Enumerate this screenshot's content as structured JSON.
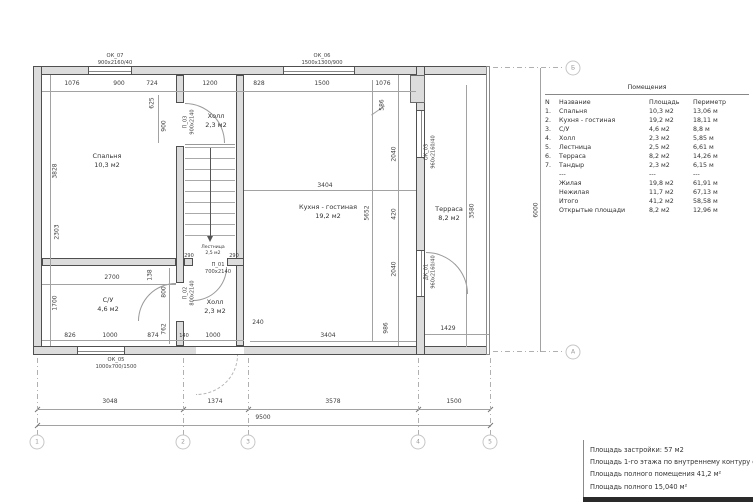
{
  "plan": {
    "rooms": {
      "bedroom": {
        "name": "Спальня",
        "area": "10,3 м2"
      },
      "hall_top": {
        "name": "Холл",
        "area": "2,3 м2"
      },
      "kitchen": {
        "name": "Кухня - гостиная",
        "area": "19,2 м2"
      },
      "terrace": {
        "name": "Терраса",
        "area": "8,2 м2"
      },
      "bathroom": {
        "name": "С/У",
        "area": "4,6 м2"
      },
      "hall_bottom": {
        "name": "Холл",
        "area": "2,3 м2"
      },
      "stairs": {
        "name": "Лестница",
        "area": "2,5 м2"
      }
    },
    "openings": {
      "ok07": {
        "code": "ОК_07",
        "size": "900х2160/40"
      },
      "ok06": {
        "code": "ОК_06",
        "size": "1500х1300/900"
      },
      "ok05": {
        "code": "ОК_05",
        "size": "1000х700/1500"
      },
      "ok03": {
        "code": "ОК_03",
        "size": "960х2160/40"
      },
      "dk01": {
        "code": "ДК_01",
        "size": "960х2160/40"
      },
      "p01": {
        "code": "П_01",
        "size": "700х2140"
      },
      "p02": {
        "code": "П_02",
        "size": "800х2140"
      },
      "p03": {
        "code": "П_03",
        "size": "900х2140"
      }
    },
    "dims": {
      "top": [
        "1076",
        "900",
        "724",
        "1200",
        "828",
        "1500",
        "1076"
      ],
      "left": [
        "3828",
        "2303",
        "1700"
      ],
      "hall_left": [
        "625",
        "900"
      ],
      "su": [
        "2700",
        "138",
        "800",
        "762"
      ],
      "bottom_inner": [
        "826",
        "1000",
        "874",
        "140",
        "1000"
      ],
      "kitchen": [
        "3404",
        "5652"
      ],
      "kitchen_bottom": [
        "240",
        "3404"
      ],
      "right_col": [
        "586",
        "2040",
        "420",
        "2040"
      ],
      "terrace": [
        "3580",
        "986",
        "1429"
      ],
      "stairs": [
        "290",
        "290"
      ],
      "bottom_chain": [
        "3048",
        "1374",
        "3578",
        "1500"
      ],
      "bottom_total": "9500",
      "height_total": "6000"
    }
  },
  "grid": {
    "columns": [
      "1",
      "2",
      "3",
      "4",
      "5"
    ],
    "rows": {
      "top": "Б",
      "bottom": "А"
    }
  },
  "table": {
    "title": "Помещения",
    "headers": {
      "n": "N",
      "name": "Название",
      "area": "Площадь",
      "perimeter": "Периметр"
    },
    "rows": [
      {
        "n": "1.",
        "name": "Спальня",
        "area": "10,3 м2",
        "perimeter": "13,06 м"
      },
      {
        "n": "2.",
        "name": "Кухня - гостиная",
        "area": "19,2 м2",
        "perimeter": "18,11 м"
      },
      {
        "n": "3.",
        "name": "С/У",
        "area": "4,6 м2",
        "perimeter": "8,8 м"
      },
      {
        "n": "4.",
        "name": "Холл",
        "area": "2,3 м2",
        "perimeter": "5,85 м"
      },
      {
        "n": "5.",
        "name": "Лестница",
        "area": "2,5 м2",
        "perimeter": "6,61 м"
      },
      {
        "n": "6.",
        "name": "Терраса",
        "area": "8,2 м2",
        "perimeter": "14,26 м"
      },
      {
        "n": "7.",
        "name": "Тандыр",
        "area": "2,3 м2",
        "perimeter": "6,15 м"
      }
    ],
    "separator": {
      "name": "---",
      "area": "---",
      "perimeter": "---"
    },
    "summary": [
      {
        "name": "Жилая",
        "area": "19,8 м2",
        "perimeter": "61,91 м"
      },
      {
        "name": "Нежилая",
        "area": "11,7 м2",
        "perimeter": "67,13 м"
      },
      {
        "name": "Итого",
        "area": "41,2 м2",
        "perimeter": "58,58 м"
      },
      {
        "name": "Открытые площади",
        "area": "8,2 м2",
        "perimeter": "12,96 м"
      }
    ]
  },
  "notes": {
    "line1": "Площадь застройки: 57 м2",
    "line2": "Площадь 1-го этажа по внутреннему контуру сте",
    "line3": "Площадь полного помещения 41,2 м²",
    "line4": "Площадь полного 15,040 м²"
  }
}
